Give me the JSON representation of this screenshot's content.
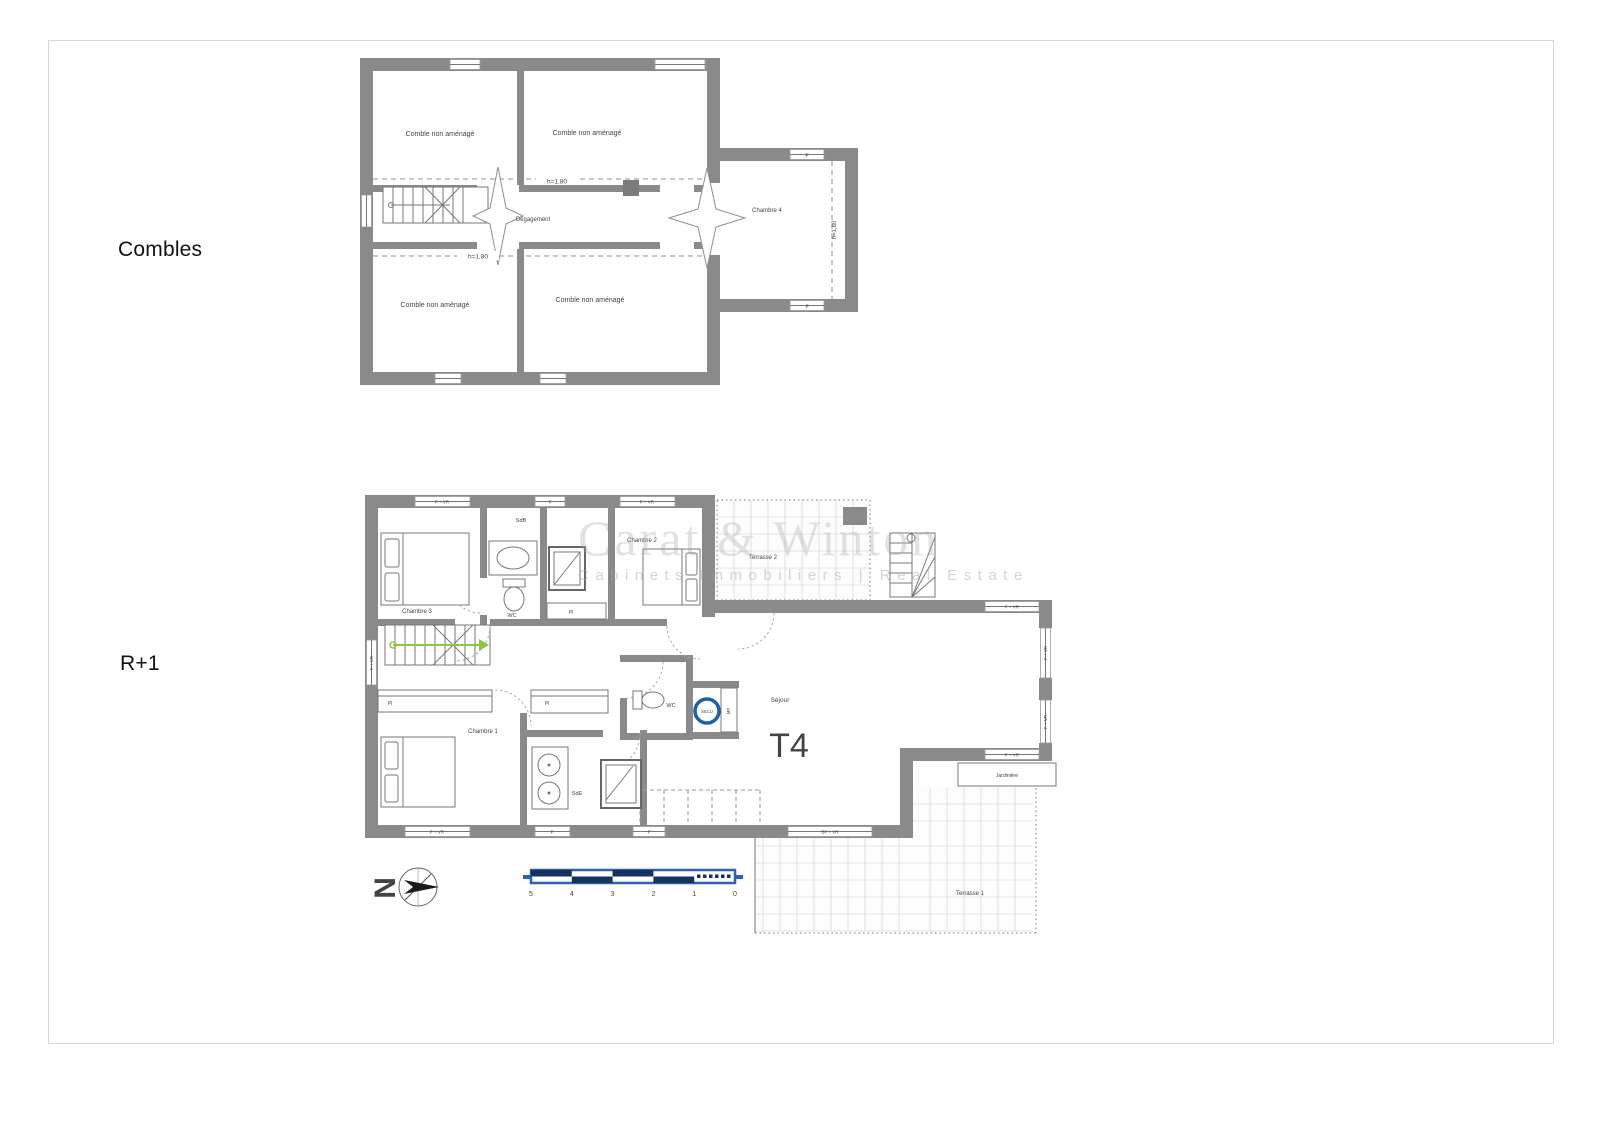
{
  "page": {
    "background": "#ffffff",
    "border_color": "#ddd6cc"
  },
  "colors": {
    "wall_gray": "#8a8a8a",
    "scale_bar_blue": "#2b64ad",
    "secu_blue": "#1f5fa8",
    "stair_arrow_green": "#8cc63f"
  },
  "watermark": {
    "name": "Carat & Winton",
    "tagline": "Cabinets Immobiliers | Real Estate"
  },
  "compass": {
    "north": "N"
  },
  "scale_bar": {
    "ticks": [
      "5",
      "4",
      "3",
      "2",
      "1",
      "0"
    ]
  },
  "floors": {
    "combles": {
      "label": "Combles",
      "rooms": {
        "comble_tl": "Comble non aménagé",
        "comble_tr": "Comble non aménagé",
        "comble_bl": "Comble non aménagé",
        "comble_br": "Comble non aménagé",
        "degagement": "Dégagement",
        "chambre4": "Chambre 4"
      },
      "heights": {
        "top": "h=1.80",
        "bottom": "h=1.80",
        "right": "h=1,80"
      },
      "windows": {
        "wing_top": "F",
        "wing_bottom": "F"
      }
    },
    "r1": {
      "label": "R+1",
      "unit_type": "T4",
      "rooms": {
        "chambre1": "Chambre 1",
        "chambre2": "Chambre 2",
        "chambre3": "Chambre 3",
        "sdb": "SdB",
        "sde": "SdE",
        "wc1": "WC",
        "wc2": "WC",
        "sejour": "Séjour",
        "terrasse1": "Terrasse 1",
        "terrasse2": "Terrasse 2",
        "jardiniere": "Jardinière",
        "pl1": "Pl",
        "pl2": "Pl",
        "pl3": "Pl",
        "mp": "MP",
        "secu": "SECU"
      },
      "windows": {
        "top1": "F + VR",
        "top2": "F",
        "top3": "F + VR",
        "left1": "F + VR",
        "sejour_top": "F + VR",
        "sejour_right1": "F + VR",
        "sejour_right2": "F + VR",
        "sejour_bottom": "F + VR",
        "terrace_door": "BF + VR",
        "bottom1": "F + VR",
        "bottom2": "F",
        "bottom3": "F"
      }
    }
  }
}
